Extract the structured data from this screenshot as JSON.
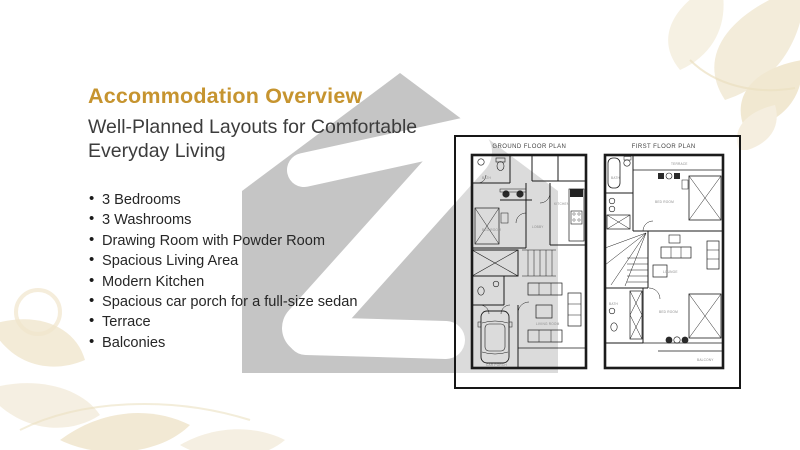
{
  "header": {
    "title": "Accommodation Overview",
    "subtitle_lines": [
      "Well-Planned Layouts for Comfortable",
      "Everyday Living"
    ]
  },
  "features": {
    "items": [
      "3 Bedrooms",
      "3 Washrooms",
      "Drawing Room with Powder Room",
      "Spacious Living Area",
      "Modern Kitchen",
      "Spacious car porch for a full-size sedan",
      "Terrace",
      "Balconies"
    ]
  },
  "floorplans": {
    "ground": {
      "title": "GROUND FLOOR PLAN",
      "labels": [
        "BATH",
        "BED ROOM",
        "KITCHEN",
        "LOBBY",
        "CAR PORCH",
        "LIVING ROOM"
      ]
    },
    "first": {
      "title": "FIRST FLOOR PLAN",
      "labels": [
        "BATH",
        "TERRACE",
        "BED ROOM",
        "LOUNGE",
        "BATH",
        "BED ROOM",
        "BALCONY"
      ]
    }
  },
  "colors": {
    "accent_gold": "#C6942F",
    "watermark_gray": "#C5C5C5",
    "decor_beige": "#F2EAD6",
    "plan_line": "#1b1b1b"
  }
}
